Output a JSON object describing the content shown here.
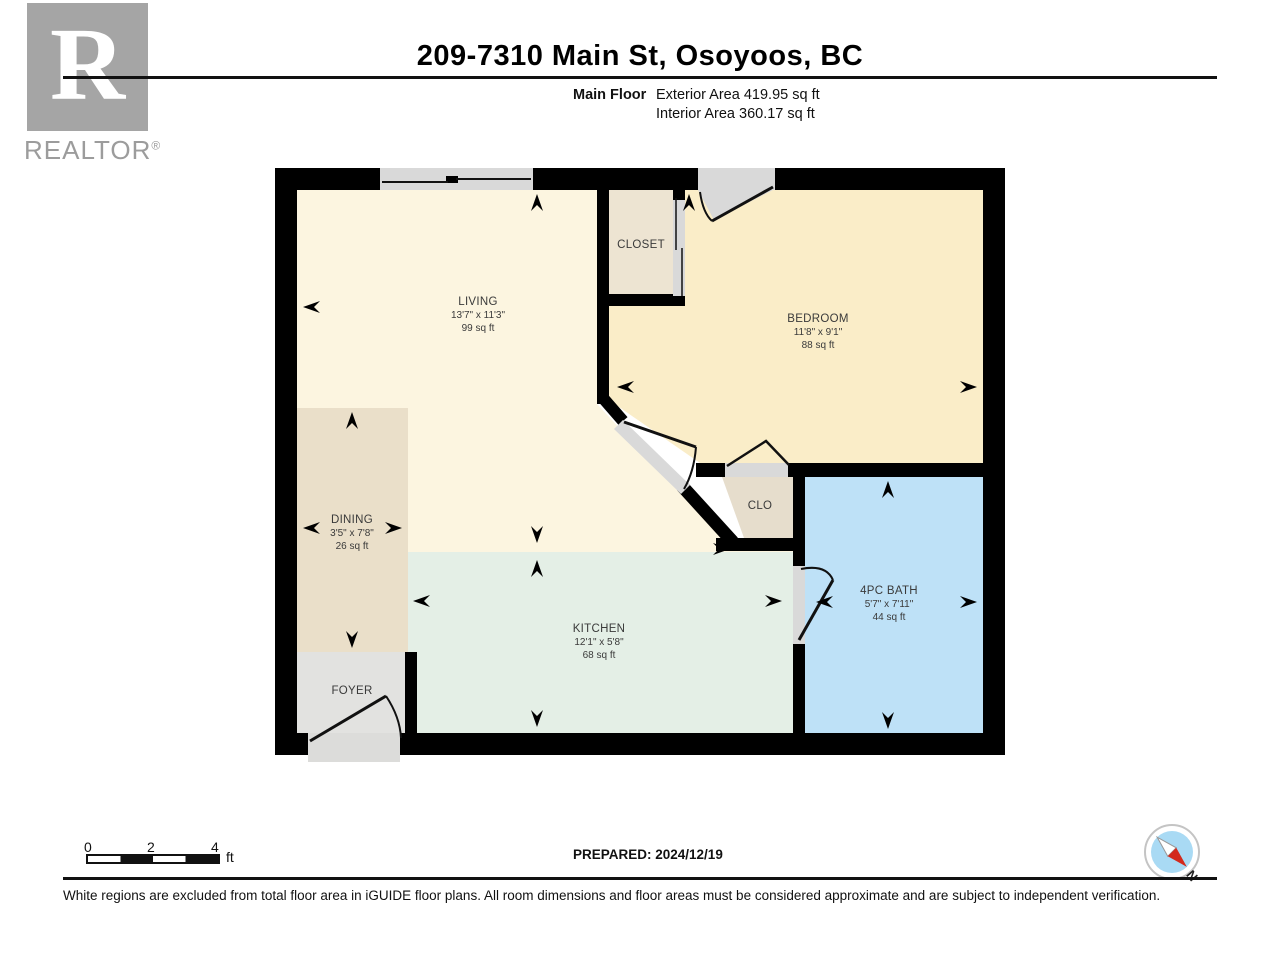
{
  "header": {
    "title": "209-7310 Main St, Osoyoos, BC",
    "floor_label": "Main Floor",
    "exterior_area": "Exterior Area 419.95 sq ft",
    "interior_area": "Interior Area 360.17 sq ft"
  },
  "logo": {
    "letter": "R",
    "brand": "REALTOR",
    "reg": "®"
  },
  "rooms": {
    "living": {
      "name": "LIVING",
      "dims": "13'7\" x 11'3\"",
      "area": "99 sq ft"
    },
    "closet": {
      "name": "CLOSET"
    },
    "bedroom": {
      "name": "BEDROOM",
      "dims": "11'8\" x 9'1\"",
      "area": "88 sq ft"
    },
    "dining": {
      "name": "DINING",
      "dims": "3'5\" x 7'8\"",
      "area": "26 sq ft"
    },
    "clo": {
      "name": "CLO"
    },
    "kitchen": {
      "name": "KITCHEN",
      "dims": "12'1\" x 5'8\"",
      "area": "68 sq ft"
    },
    "foyer": {
      "name": "FOYER"
    },
    "bath": {
      "name": "4PC BATH",
      "dims": "5'7\" x 7'11\"",
      "area": "44 sq ft"
    }
  },
  "scale_bar": {
    "tick0": "0",
    "tick2": "2",
    "tick4": "4",
    "unit": "ft"
  },
  "footer": {
    "prepared": "PREPARED: 2024/12/19",
    "disclaimer": "White regions are excluded from total floor area in iGUIDE floor plans. All room dimensions and floor areas must be considered approximate and are subject to independent verification."
  },
  "compass": {
    "north_label": "N"
  },
  "colors": {
    "wall": "#000000",
    "living": "#FCF5E0",
    "bedroom": "#FAEDC8",
    "closet": "#EDE4D2",
    "clo": "#E6DDCC",
    "dining": "#EADFC9",
    "kitchen": "#E4EFE6",
    "foyer": "#E2E2E0",
    "bath": "#BEE1F7",
    "opening_gray": "#D9D9D9",
    "compass_blue": "#A9DAF4",
    "compass_red": "#D3291C"
  }
}
